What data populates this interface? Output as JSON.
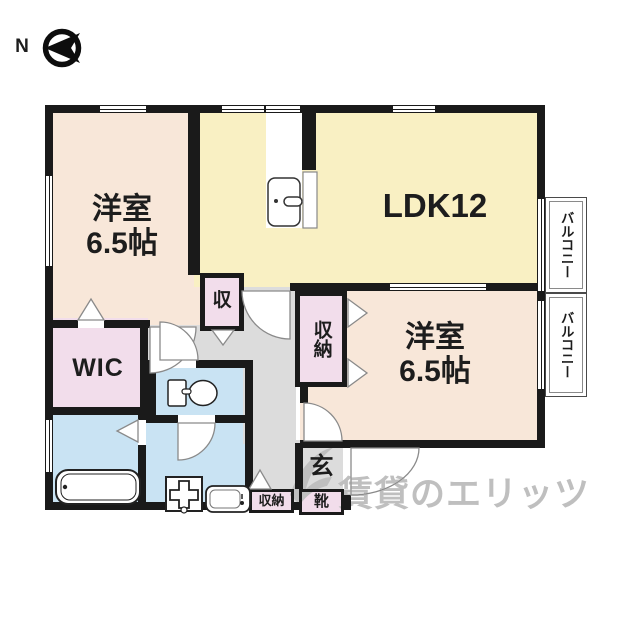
{
  "compass": {
    "north_label": "N"
  },
  "plan": {
    "bedroom_top_left": {
      "name": "洋室",
      "size": "6.5帖"
    },
    "ldk": {
      "label": "LDK12"
    },
    "bedroom_bottom_right": {
      "name": "洋室",
      "size": "6.5帖"
    },
    "wic": {
      "label": "WIC"
    },
    "balcony_upper": {
      "label": "バルコニー"
    },
    "balcony_lower": {
      "label": "バルコニー"
    },
    "hall_storage": {
      "label": "収"
    },
    "bedroom_closet": {
      "label": "収納"
    },
    "entrance": {
      "label": "玄"
    },
    "shoe_box": {
      "label": "靴"
    },
    "entrance_storage": {
      "label": "収納"
    }
  },
  "watermark": {
    "text": "賃貸のエリッツ"
  },
  "colors": {
    "bedroom_floor": "#f8e7d9",
    "ldk_floor": "#f9f0c3",
    "closet_floor": "#f2ddeb",
    "wet_area_floor": "#c9e3f3",
    "hallway_floor": "#dcdcdc",
    "wall": "#1a1a1a",
    "watermark": "#bfbfbf"
  }
}
